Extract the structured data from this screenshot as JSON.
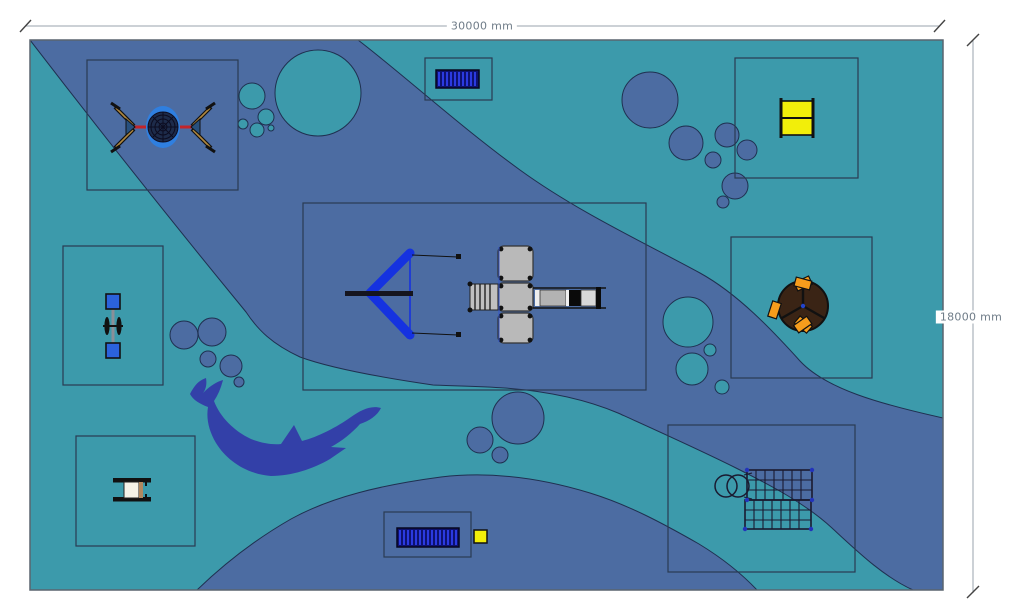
{
  "scene": {
    "type": "playground-plan-top-view"
  },
  "dimension_labels": {
    "width": "30000 mm",
    "height": "18000 mm"
  },
  "colors": {
    "teal": "#3c9aab",
    "band": "#4c6ca2",
    "edge": "#1f3050",
    "dolphin": "#3340a8",
    "zone_stroke": "#2a3b52",
    "border": "#5a646e",
    "dim_line": "#9aa3ac",
    "dim_text": "#6f7c88",
    "accent_blue": "#1532e0",
    "ring_blue": "#2f7fe0",
    "seat_blue": "#2b62dc",
    "bench_navy": "#0d1270",
    "bench_slat": "#2b3ae0",
    "yellow": "#f2ee0a",
    "orange": "#f59c1c",
    "brown": "#3a2415",
    "red": "#c3242a",
    "platform_gray": "#b9b9b9",
    "frame_tan": "#b08840",
    "ink": "#111111",
    "table_top": "#f5f2e8",
    "wood": "#b08860"
  },
  "equipment_names": [
    "rope-spinner",
    "bench",
    "cube-playhouse",
    "v-rope-climber",
    "play-tower-with-slide",
    "seesaw",
    "spinner-carousel",
    "picnic-table",
    "bench",
    "litter-bin",
    "climbing-net"
  ],
  "decor_names": [
    "dolphin-motif",
    "bubbles",
    "water-band"
  ]
}
